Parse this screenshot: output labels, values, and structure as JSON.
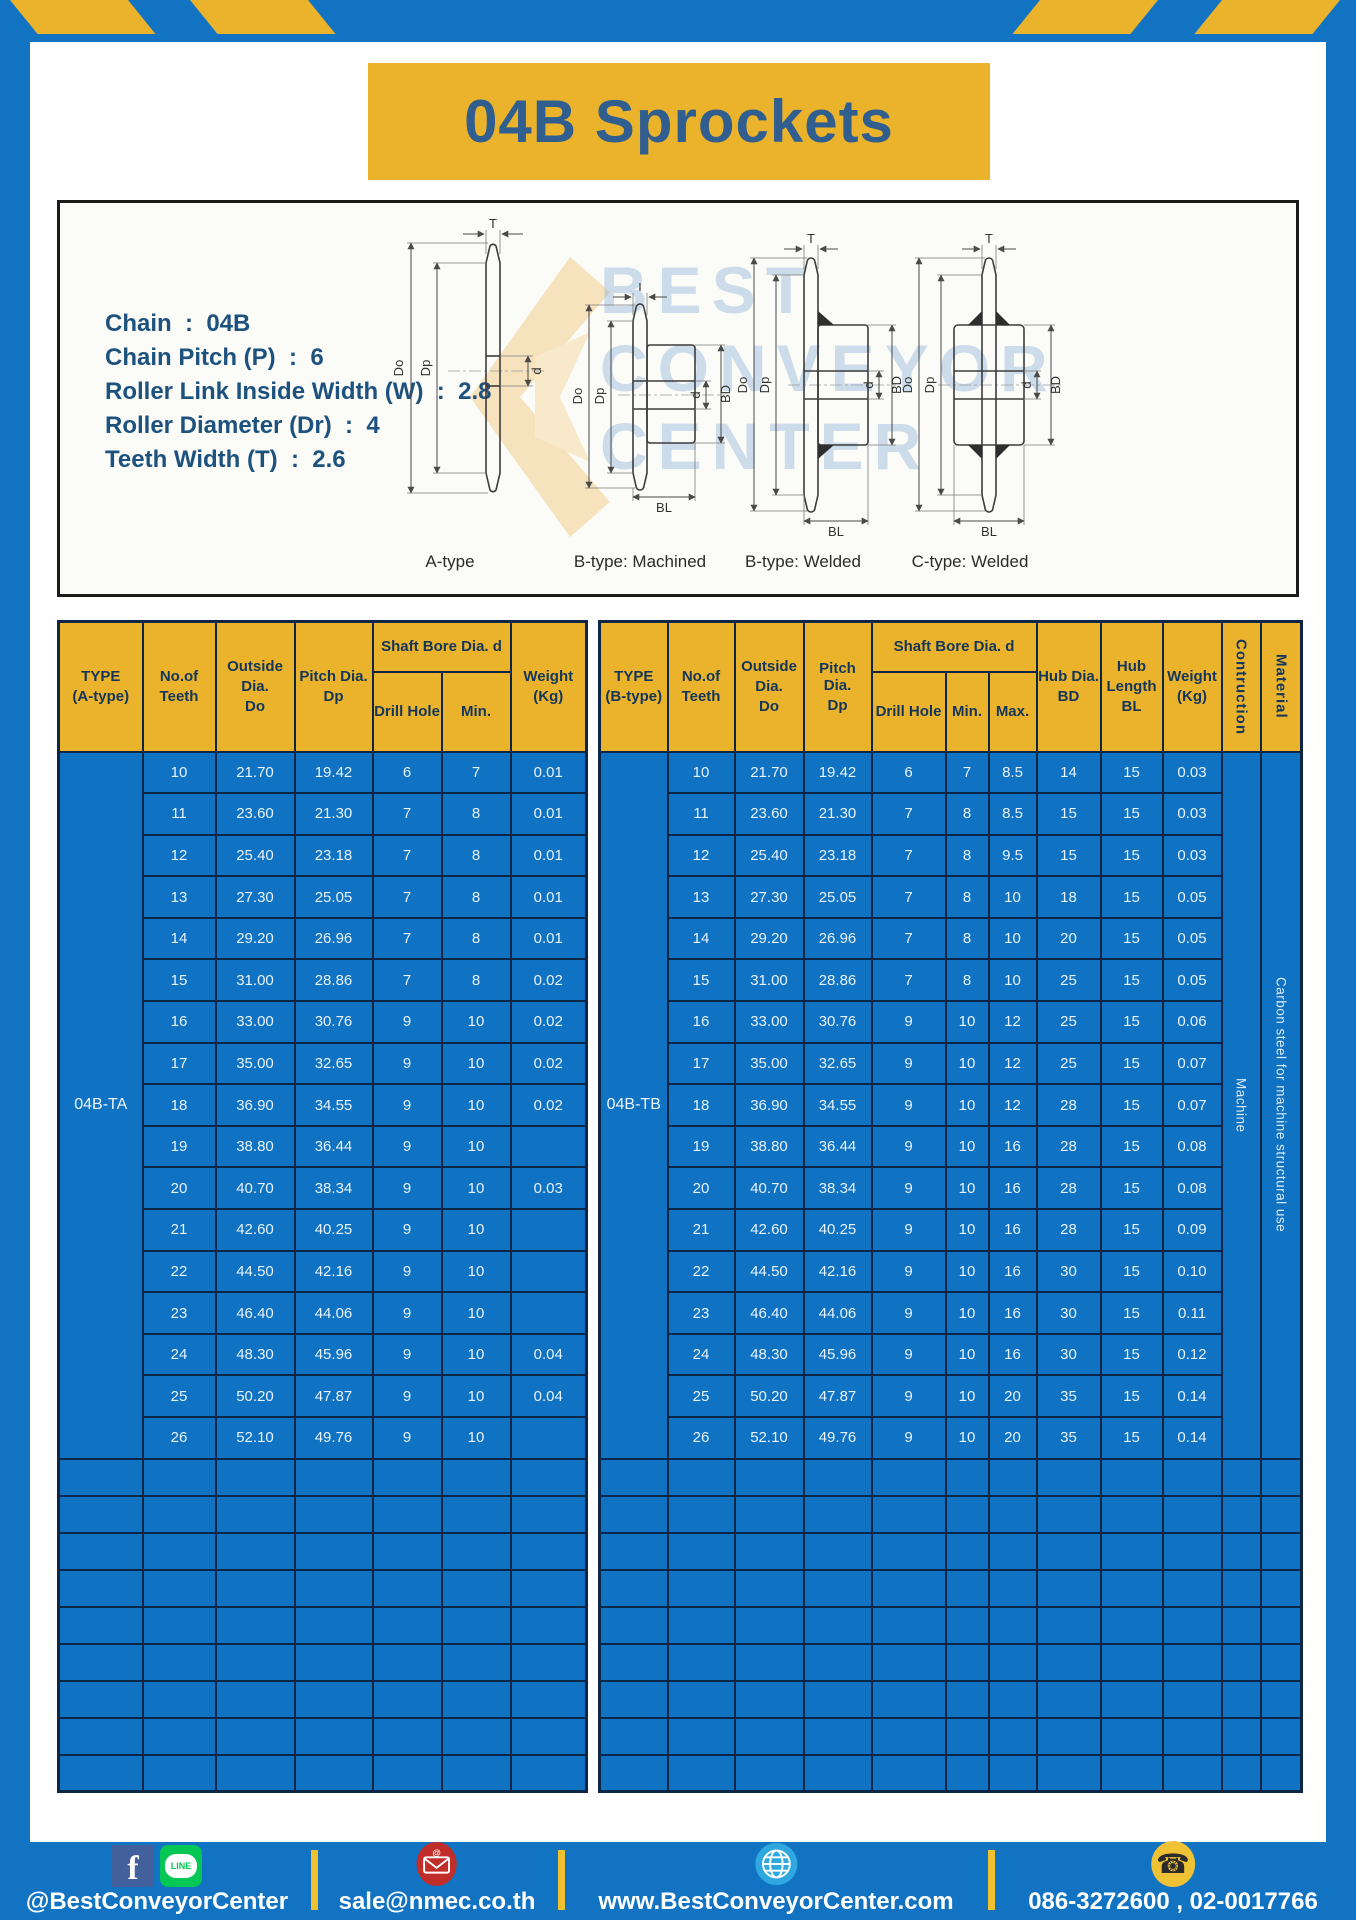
{
  "page": {
    "title": "04B Sprockets"
  },
  "specs": {
    "lines": [
      "Chain  :  04B",
      "Chain Pitch (P)  :  6",
      "Roller Link Inside Width (W)  :  2.8",
      "Roller Diameter (Dr)  :  4",
      "Teeth Width (T)  :  2.6"
    ]
  },
  "drawings": {
    "watermark": {
      "line1": "BEST",
      "line2": "CONVEYOR",
      "line3": "CENTER"
    },
    "dim_labels": {
      "t": "T",
      "outside": "Do",
      "pitch": "Dp",
      "bore": "d",
      "hub": "BD",
      "hub_len": "BL"
    },
    "type_labels": [
      "A-type",
      "B-type: Machined",
      "B-type: Welded",
      "C-type: Welded"
    ]
  },
  "table_headers": {
    "type": "TYPE",
    "no_of": "No.of",
    "teeth": "Teeth",
    "outside": "Outside",
    "dia": "Dia.",
    "do": "Do",
    "pitch_dia": "Pitch Dia.",
    "dp": "Dp",
    "shaft_bore": "Shaft Bore Dia. d",
    "drill_hole": "Drill Hole",
    "min": "Min.",
    "max": "Max.",
    "hub_dia": "Hub Dia.",
    "bd": "BD",
    "hub": "Hub",
    "length": "Length",
    "bl": "BL",
    "weight": "Weight",
    "kg": "(Kg)",
    "construction": "Contruction",
    "material": "Material"
  },
  "table_a": {
    "type_sub": "(A-type)",
    "type_value": "04B-TA",
    "empty_row_count": 9,
    "rows": [
      [
        "10",
        "21.70",
        "19.42",
        "6",
        "7",
        "0.01"
      ],
      [
        "11",
        "23.60",
        "21.30",
        "7",
        "8",
        "0.01"
      ],
      [
        "12",
        "25.40",
        "23.18",
        "7",
        "8",
        "0.01"
      ],
      [
        "13",
        "27.30",
        "25.05",
        "7",
        "8",
        "0.01"
      ],
      [
        "14",
        "29.20",
        "26.96",
        "7",
        "8",
        "0.01"
      ],
      [
        "15",
        "31.00",
        "28.86",
        "7",
        "8",
        "0.02"
      ],
      [
        "16",
        "33.00",
        "30.76",
        "9",
        "10",
        "0.02"
      ],
      [
        "17",
        "35.00",
        "32.65",
        "9",
        "10",
        "0.02"
      ],
      [
        "18",
        "36.90",
        "34.55",
        "9",
        "10",
        "0.02"
      ],
      [
        "19",
        "38.80",
        "36.44",
        "9",
        "10",
        ""
      ],
      [
        "20",
        "40.70",
        "38.34",
        "9",
        "10",
        "0.03"
      ],
      [
        "21",
        "42.60",
        "40.25",
        "9",
        "10",
        ""
      ],
      [
        "22",
        "44.50",
        "42.16",
        "9",
        "10",
        ""
      ],
      [
        "23",
        "46.40",
        "44.06",
        "9",
        "10",
        ""
      ],
      [
        "24",
        "48.30",
        "45.96",
        "9",
        "10",
        "0.04"
      ],
      [
        "25",
        "50.20",
        "47.87",
        "9",
        "10",
        "0.04"
      ],
      [
        "26",
        "52.10",
        "49.76",
        "9",
        "10",
        ""
      ]
    ]
  },
  "table_b": {
    "type_sub": "(B-type)",
    "type_value": "04B-TB",
    "construction_value": "Machine",
    "material_value": "Carbon steel for machine structural use",
    "empty_row_count": 9,
    "rows": [
      [
        "10",
        "21.70",
        "19.42",
        "6",
        "7",
        "8.5",
        "14",
        "15",
        "0.03"
      ],
      [
        "11",
        "23.60",
        "21.30",
        "7",
        "8",
        "8.5",
        "15",
        "15",
        "0.03"
      ],
      [
        "12",
        "25.40",
        "23.18",
        "7",
        "8",
        "9.5",
        "15",
        "15",
        "0.03"
      ],
      [
        "13",
        "27.30",
        "25.05",
        "7",
        "8",
        "10",
        "18",
        "15",
        "0.05"
      ],
      [
        "14",
        "29.20",
        "26.96",
        "7",
        "8",
        "10",
        "20",
        "15",
        "0.05"
      ],
      [
        "15",
        "31.00",
        "28.86",
        "7",
        "8",
        "10",
        "25",
        "15",
        "0.05"
      ],
      [
        "16",
        "33.00",
        "30.76",
        "9",
        "10",
        "12",
        "25",
        "15",
        "0.06"
      ],
      [
        "17",
        "35.00",
        "32.65",
        "9",
        "10",
        "12",
        "25",
        "15",
        "0.07"
      ],
      [
        "18",
        "36.90",
        "34.55",
        "9",
        "10",
        "12",
        "28",
        "15",
        "0.07"
      ],
      [
        "19",
        "38.80",
        "36.44",
        "9",
        "10",
        "16",
        "28",
        "15",
        "0.08"
      ],
      [
        "20",
        "40.70",
        "38.34",
        "9",
        "10",
        "16",
        "28",
        "15",
        "0.08"
      ],
      [
        "21",
        "42.60",
        "40.25",
        "9",
        "10",
        "16",
        "28",
        "15",
        "0.09"
      ],
      [
        "22",
        "44.50",
        "42.16",
        "9",
        "10",
        "16",
        "30",
        "15",
        "0.10"
      ],
      [
        "23",
        "46.40",
        "44.06",
        "9",
        "10",
        "16",
        "30",
        "15",
        "0.11"
      ],
      [
        "24",
        "48.30",
        "45.96",
        "9",
        "10",
        "16",
        "30",
        "15",
        "0.12"
      ],
      [
        "25",
        "50.20",
        "47.87",
        "9",
        "10",
        "20",
        "35",
        "15",
        "0.14"
      ],
      [
        "26",
        "52.10",
        "49.76",
        "9",
        "10",
        "20",
        "35",
        "15",
        "0.14"
      ]
    ]
  },
  "footer": {
    "social_text": "@BestConveyorCenter",
    "email": "sale@nmec.co.th",
    "website": "www.BestConveyorCenter.com",
    "phones": "086-3272600 , 02-0017766",
    "icons": {
      "facebook_glyph": "f",
      "line_glyph": "LINE",
      "phone_glyph": "☎",
      "mail_at_glyph": "@"
    }
  },
  "colors": {
    "brand_blue": "#1173C2",
    "brand_yellow": "#EBB32B",
    "border_navy": "#0D2646",
    "title_navy": "#2F5E8F"
  }
}
